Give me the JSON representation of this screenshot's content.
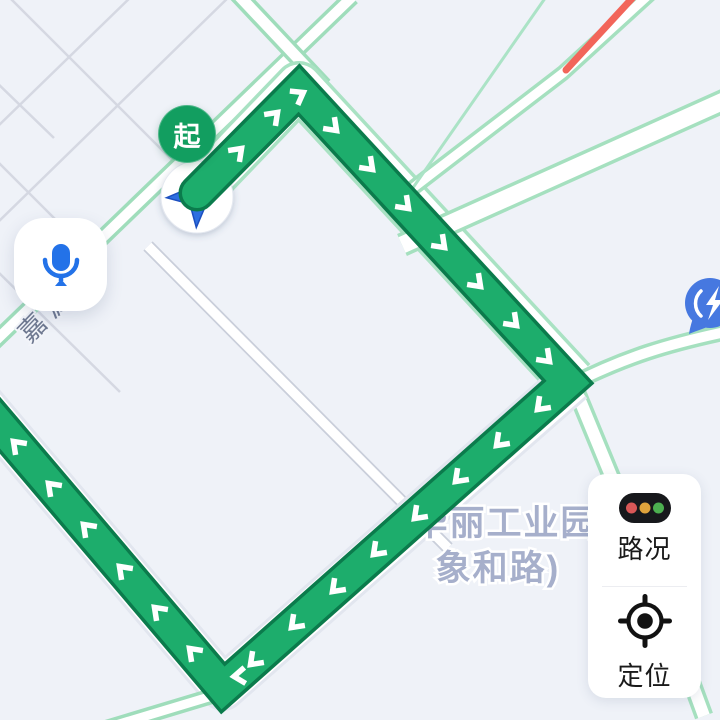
{
  "map": {
    "start_marker": {
      "label": "起"
    },
    "road_label": "嘉源路",
    "poi_label": {
      "line1": "华丽工业园",
      "line2": "象和路)"
    },
    "position_marker": "navigation-arrow",
    "charging_station_marker": "ev-charging-pin",
    "congestion_segment": "red traffic section on north-east road"
  },
  "controls": {
    "voice_button": {
      "icon": "microphone"
    },
    "traffic_button": {
      "label": "路况"
    },
    "locate_button": {
      "label": "定位"
    }
  },
  "colors": {
    "background": "#EFF2F8",
    "route_green": "#1DAD6C",
    "route_border": "#0B7B4C",
    "route_chevron": "#FFFFFF",
    "road_casing_green": "#A5E0BF",
    "minor_road_gray": "#D5D8E2",
    "congestion_red": "#F2655A",
    "mic_blue": "#2372E8",
    "pin_blue": "#4678E0",
    "arrow_blue": "#2E6FE0",
    "start_marker_green": "#129E60",
    "traffic_dot_red": "#D95757",
    "traffic_dot_yellow": "#DFA33C",
    "traffic_dot_green": "#4CAF50",
    "poi_text": "#A6AFCB",
    "road_text": "#6E7890"
  }
}
